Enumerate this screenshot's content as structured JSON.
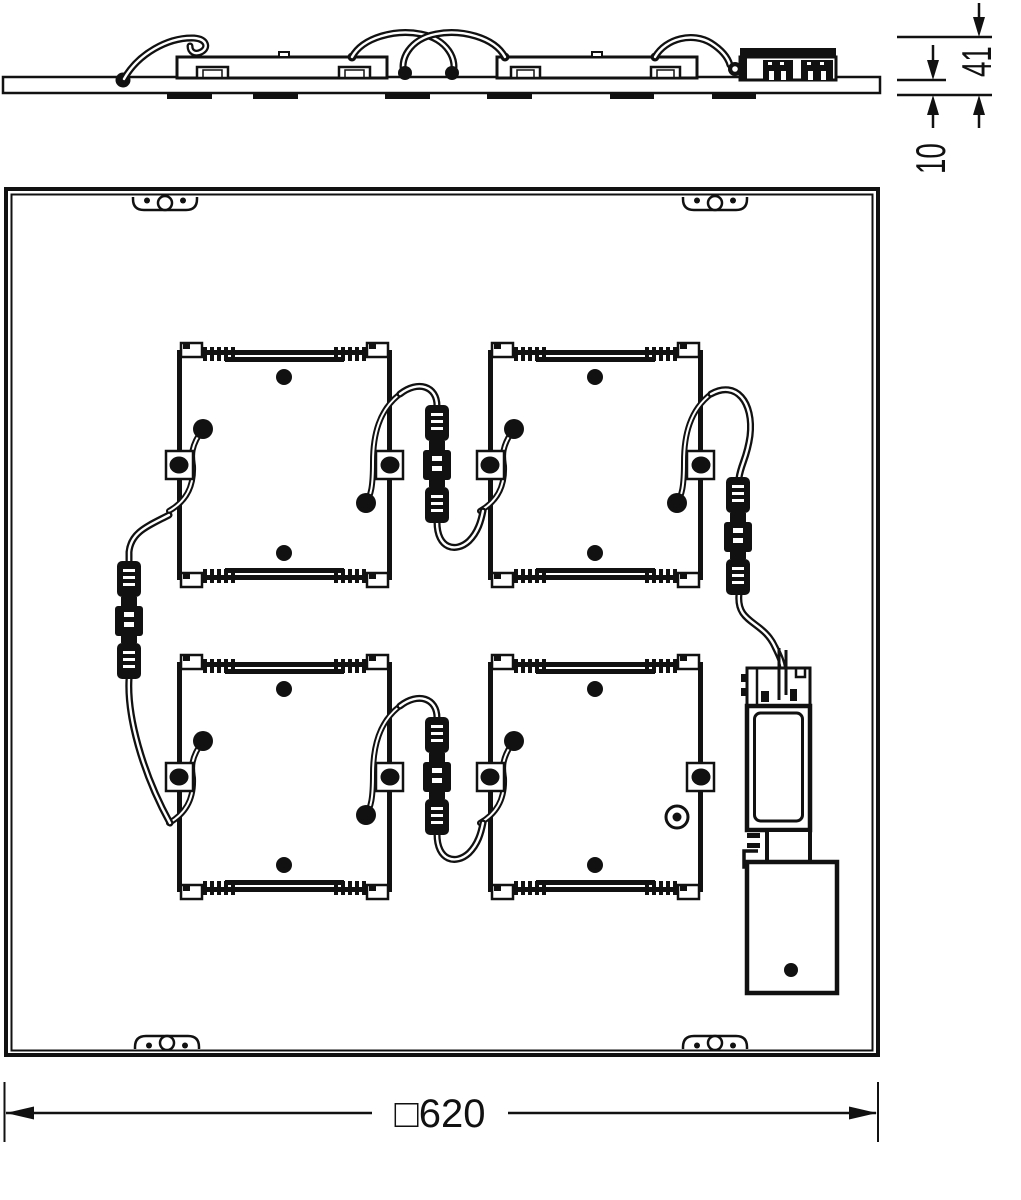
{
  "colors": {
    "ink": "#111111",
    "paper": "#ffffff"
  },
  "dimensions": {
    "side_total_height": "41",
    "panel_thickness": "10",
    "panel_size_label": "□620"
  }
}
